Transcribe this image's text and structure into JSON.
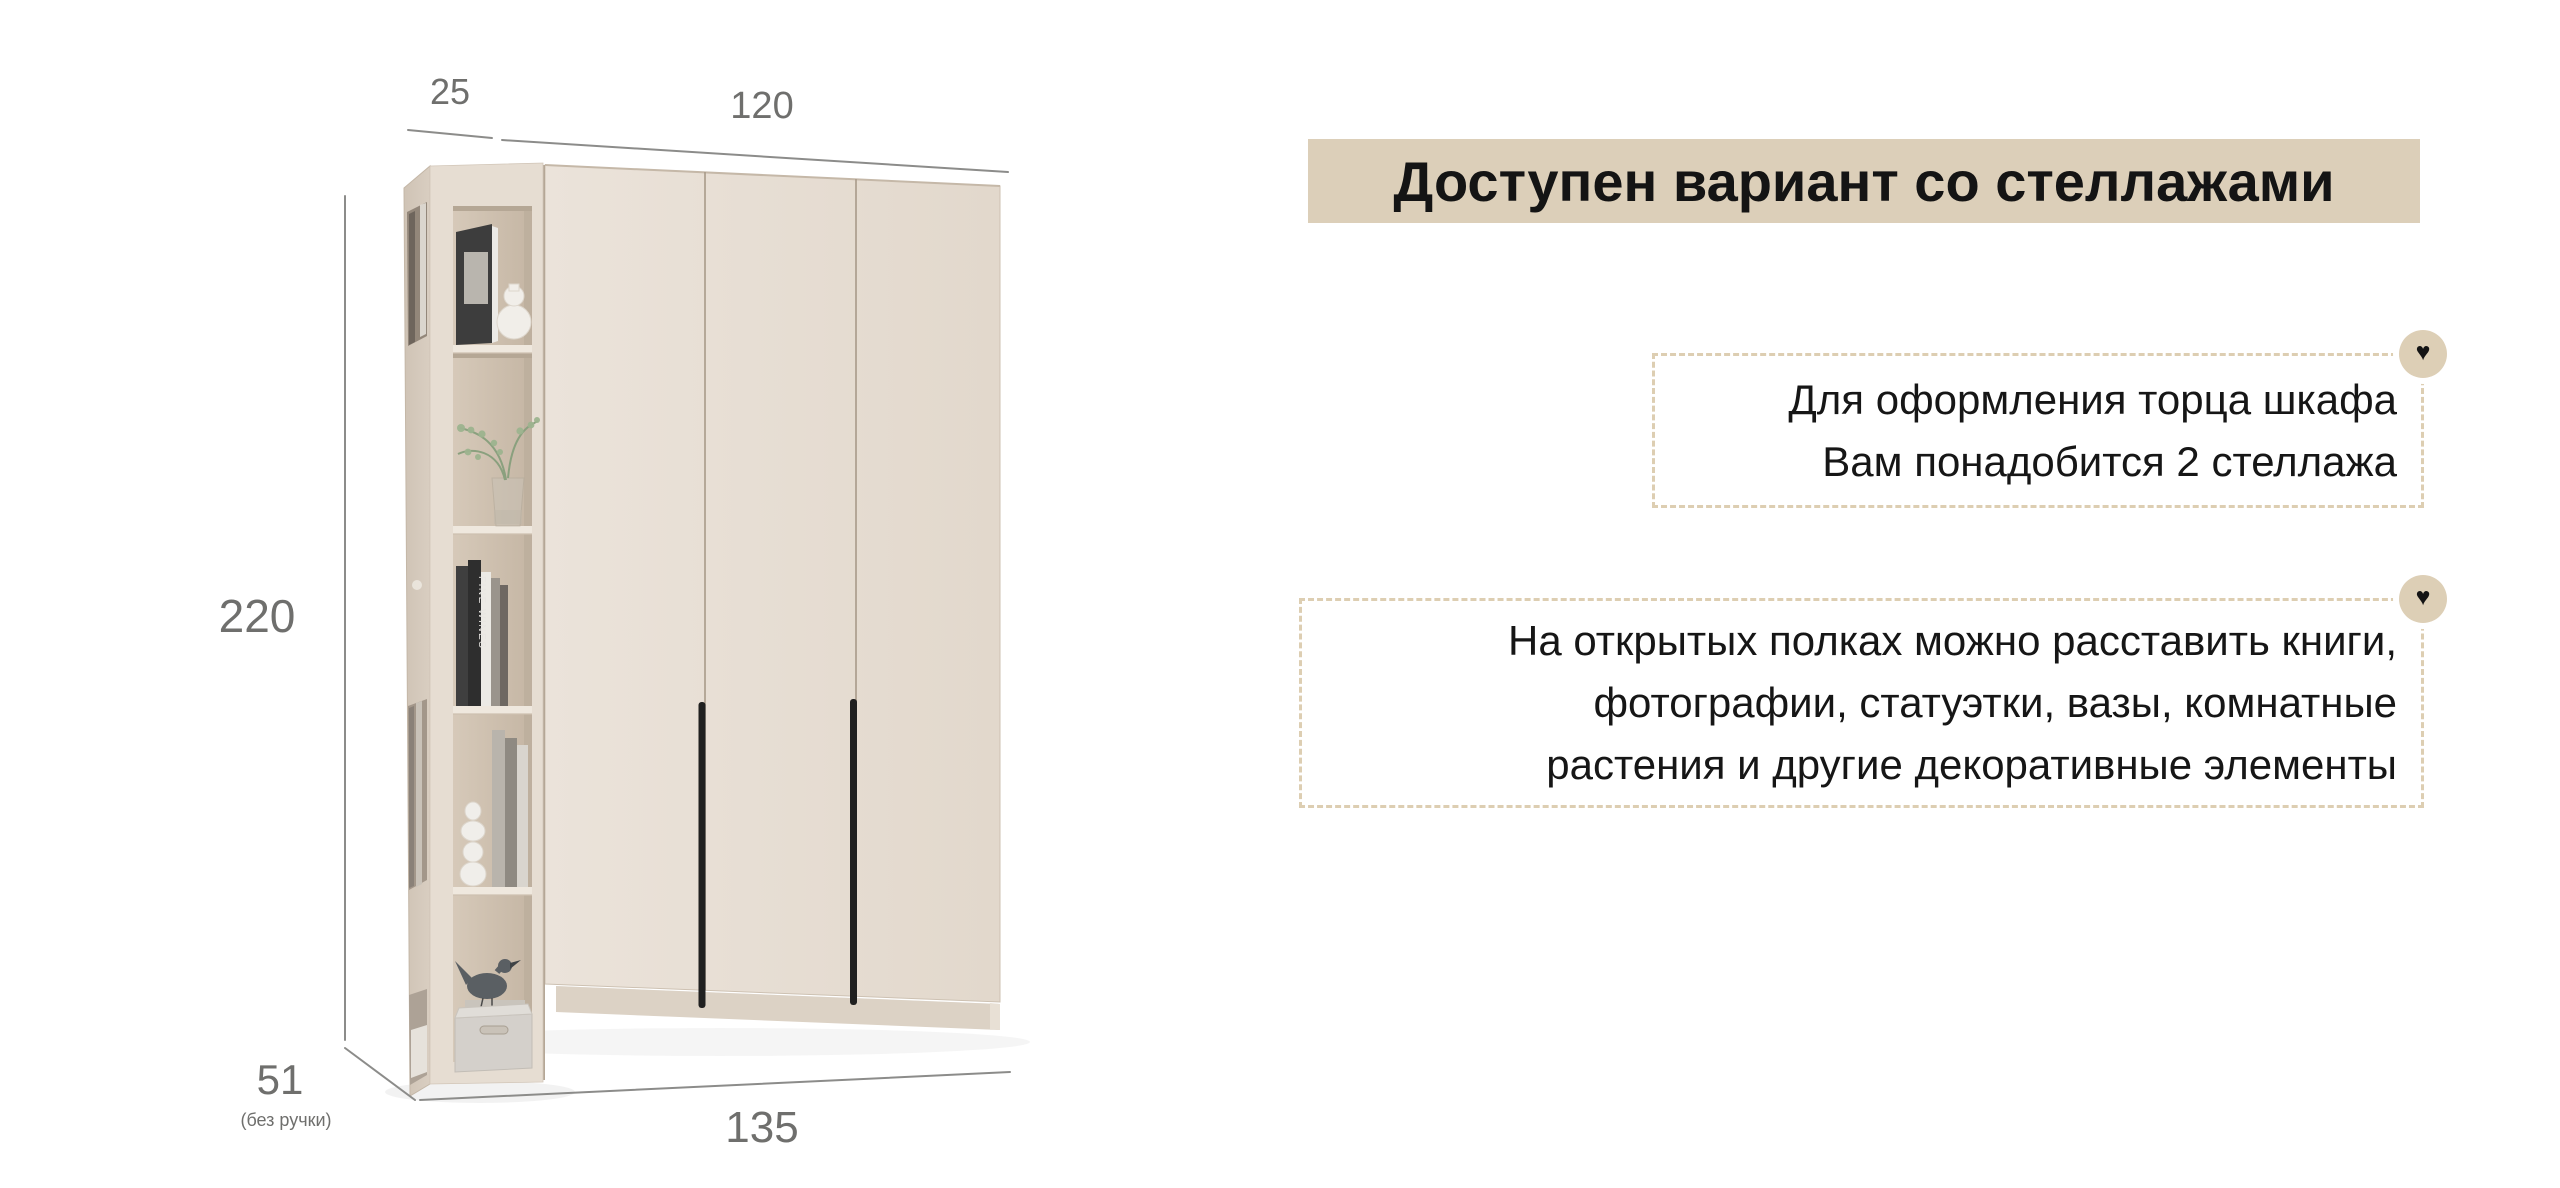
{
  "page": {
    "background": "#ffffff"
  },
  "banner": {
    "title": "Доступен вариант со стеллажами"
  },
  "notes": {
    "note1": {
      "line1": "Для оформления торца шкафа",
      "line2": "Вам понадобится 2 стеллажа"
    },
    "note2": {
      "line1": "На открытых полках можно расставить книги,",
      "line2": "фотографии, статуэтки, вазы, комнатные",
      "line3": "растения и другие декоративные элементы"
    }
  },
  "icons": {
    "heart": "♥"
  },
  "dimensions": {
    "shelf_width": "25",
    "wardrobe_width": "120",
    "height": "220",
    "depth": "51",
    "depth_note": "(без ручки)",
    "total_width": "135"
  },
  "furniture": {
    "book_spine": "FINE WINES"
  },
  "colors": {
    "banner_bg": "#dccfb9",
    "dashed_border": "#ddceb2",
    "heart_badge_bg": "#ddcfb6",
    "heart": "#141414",
    "text": "#161616",
    "dimension": "#6f6f6d",
    "door_face": "#e7dfd4",
    "handle": "#202020"
  }
}
